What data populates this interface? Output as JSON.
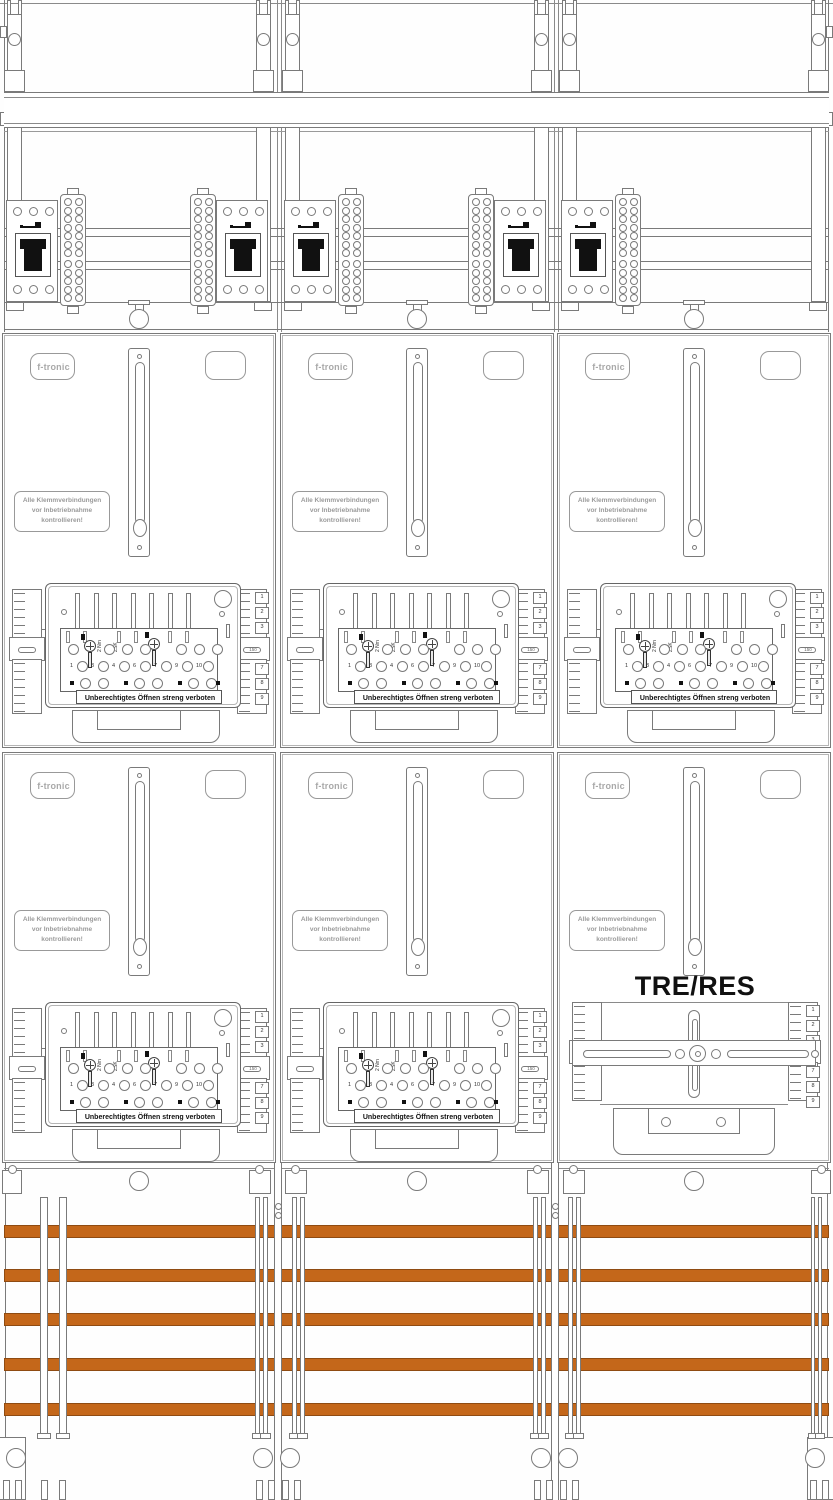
{
  "branding": {
    "logo_text": "f-tronic"
  },
  "labels": {
    "warning_line1": "Alle Klemmverbindungen",
    "warning_line2": "vor Inbetriebnahme",
    "warning_line3": "kontrollieren!",
    "seal_warning": "Unberechtigtes Öffnen streng verboten",
    "torque": "2 Nm",
    "block_model": "ZSK",
    "reserve_field": "TRE/RES",
    "comb_mid_label": "150"
  },
  "terminal_row_numbers": [
    "1",
    "3",
    "4",
    "6",
    "7",
    "9",
    "10"
  ],
  "comb_top_numbers": [
    "1",
    "2",
    "3"
  ],
  "comb_bottom_numbers": [
    "7",
    "8",
    "9"
  ],
  "busbar_count": 5,
  "columns": 3,
  "colors": {
    "busbar_fill": "#C4671A",
    "busbar_edge": "#8F4B12"
  }
}
